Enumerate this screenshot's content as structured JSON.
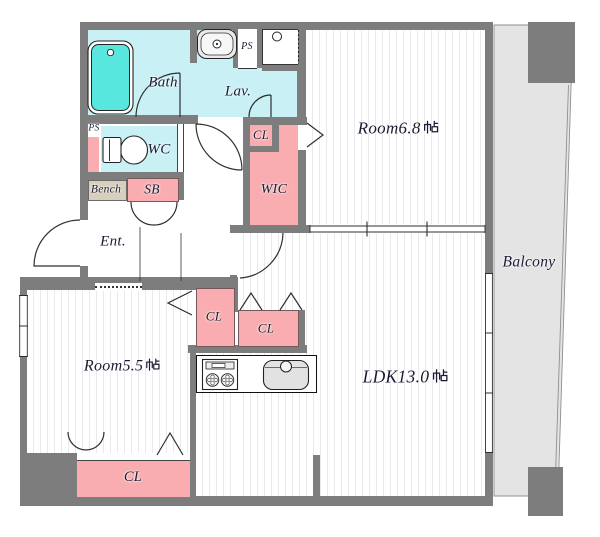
{
  "plan_title": "apartment-floor-plan",
  "colors": {
    "wall": "#7d7d7d",
    "wet": "#c9f1f5",
    "tub": "#58e7df",
    "closet": "#f9adb0",
    "bench": "#d7cebb",
    "balcony": "#e4e4e4",
    "stripe": "#e9e9ee",
    "line": "#2f2f2f",
    "text": "#1b1b33"
  },
  "labels": {
    "bath": "Bath",
    "lav": "Lav.",
    "ps_top": "PS",
    "ps_left": "PS",
    "wc": "WC",
    "bench": "Bench",
    "sb": "SB",
    "ent": "Ent.",
    "cl_upper": "CL",
    "wic": "WIC",
    "room_ne": "Room6.8帖",
    "room_sw": "Room5.5帖",
    "ldk": "LDK13.0帖",
    "balcony": "Balcony",
    "cl_mid_left": "CL",
    "cl_mid_right": "CL",
    "cl_bottom": "CL"
  }
}
